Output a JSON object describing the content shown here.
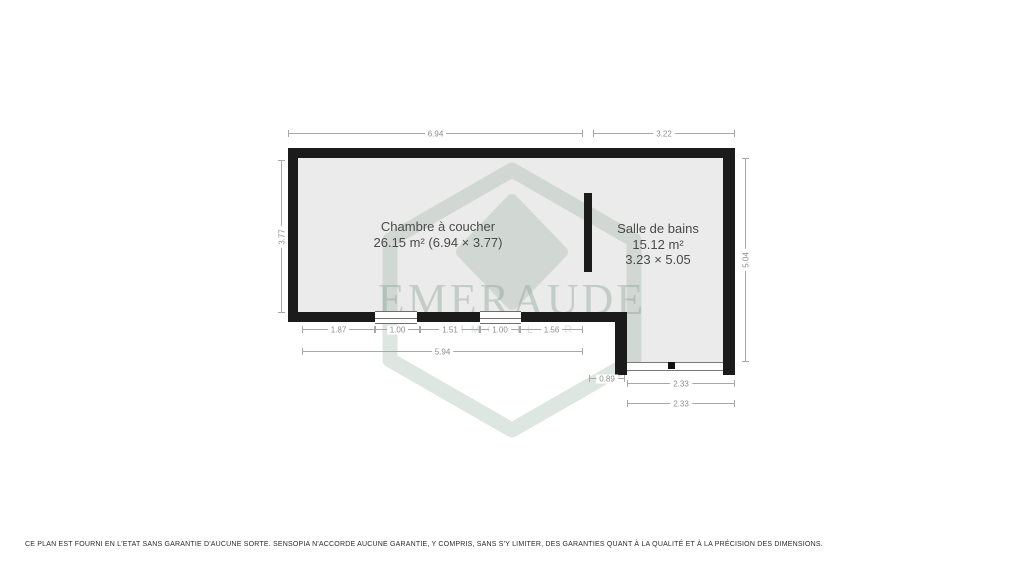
{
  "watermark": {
    "brand": "EMERAUDE",
    "tagline": "IMMOBILIER"
  },
  "rooms": {
    "bedroom": {
      "name": "Chambre à coucher",
      "area": "26.15 m² (6.94 × 3.77)"
    },
    "bathroom": {
      "name": "Salle de bains",
      "area": "15.12 m²",
      "dims": "3.23 × 5.05"
    }
  },
  "dimensions": {
    "top_bedroom": "6.94",
    "top_bathroom": "3.22",
    "left_height": "3.77",
    "right_height": "5.04",
    "bottom_segments": [
      "1.87",
      "1.00",
      "1.51",
      "1.00",
      "1.56"
    ],
    "bottom_total": "5.94",
    "notch_width": "0.89",
    "bath_bottom_door": "2.33",
    "bath_bottom_total": "2.33"
  },
  "disclaimer": "CE PLAN EST FOURNI EN L'ETAT SANS GARANTIE D'AUCUNE SORTE. SENSOPIA N'ACCORDE AUCUNE GARANTIE, Y COMPRIS, SANS S'Y LIMITER, DES GARANTIES QUANT À LA QUALITÉ ET À LA PRÉCISION DES DIMENSIONS.",
  "colors": {
    "wall": "#1b1b1b",
    "floor": "#ebebeb",
    "dimension": "#8d8d8d",
    "label": "#4a4a4a",
    "watermark": "#9cb3a6"
  }
}
